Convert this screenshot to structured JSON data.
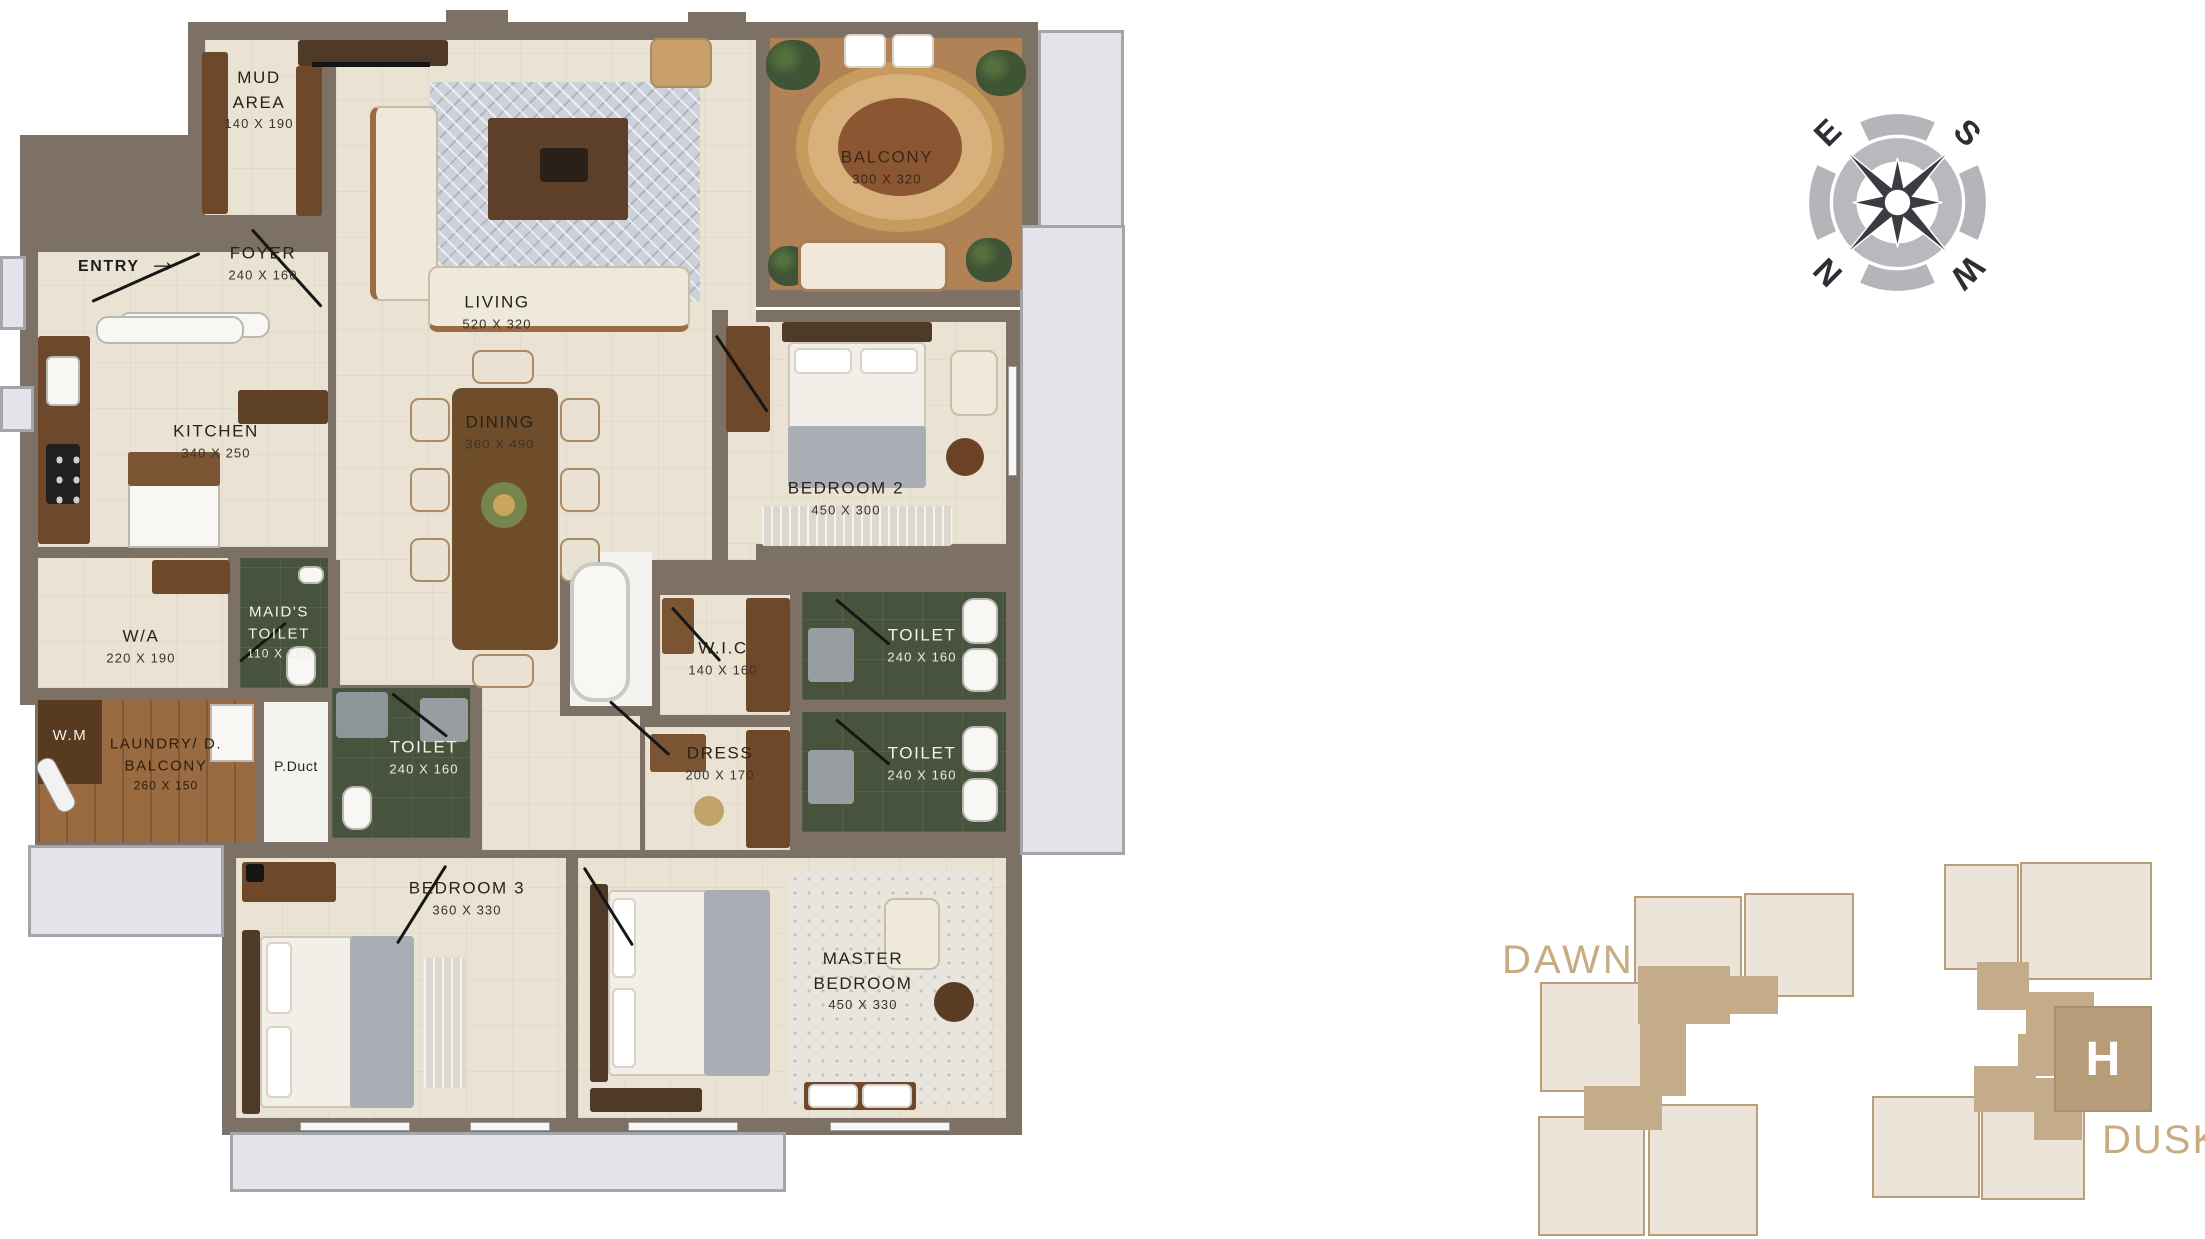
{
  "floorplan": {
    "entry_label": "ENTRY",
    "rooms": [
      {
        "name": "MUD AREA",
        "dims": "140 X 190"
      },
      {
        "name": "FOYER",
        "dims": "240 X 160"
      },
      {
        "name": "LIVING",
        "dims": "520 X 320"
      },
      {
        "name": "BALCONY",
        "dims": "300 X 320"
      },
      {
        "name": "KITCHEN",
        "dims": "340 X 250"
      },
      {
        "name": "DINING",
        "dims": "360 X 490"
      },
      {
        "name": "BEDROOM 2",
        "dims": "450 X 300"
      },
      {
        "name": "W/A",
        "dims": "220 X 190"
      },
      {
        "name": "MAID'S TOILET",
        "dims": "110 X 160"
      },
      {
        "name": "W.M",
        "dims": ""
      },
      {
        "name": "LAUNDRY/ D. BALCONY",
        "dims": "260 X 150"
      },
      {
        "name": "P.Duct",
        "dims": ""
      },
      {
        "name": "TOILET",
        "dims": "240 X 160"
      },
      {
        "name": "W.I.C",
        "dims": "140 X 160"
      },
      {
        "name": "DRESS",
        "dims": "200 X 170"
      },
      {
        "name": "TOILET",
        "dims": "240 X 160"
      },
      {
        "name": "TOILET",
        "dims": "240 X 160"
      },
      {
        "name": "BEDROOM 3",
        "dims": "360 X 330"
      },
      {
        "name": "MASTER BEDROOM",
        "dims": "450 X 330"
      }
    ]
  },
  "compass": {
    "n": "N",
    "e": "E",
    "s": "S",
    "w": "W"
  },
  "keyplans": {
    "dawn_label": "DAWN",
    "dusk_label": "DUSK",
    "unit_label": "H"
  },
  "colors": {
    "wall": "#7c7164",
    "floor_cream": "#eae3d4",
    "toilet_green": "#47533c",
    "wood_floor": "#9a6a40",
    "outside_gray": "#e2e4e9",
    "keyplan_tan": "#c8ab81",
    "keyplan_unit_fill": "#ece4d8",
    "keyplan_core": "#c4ab89"
  }
}
